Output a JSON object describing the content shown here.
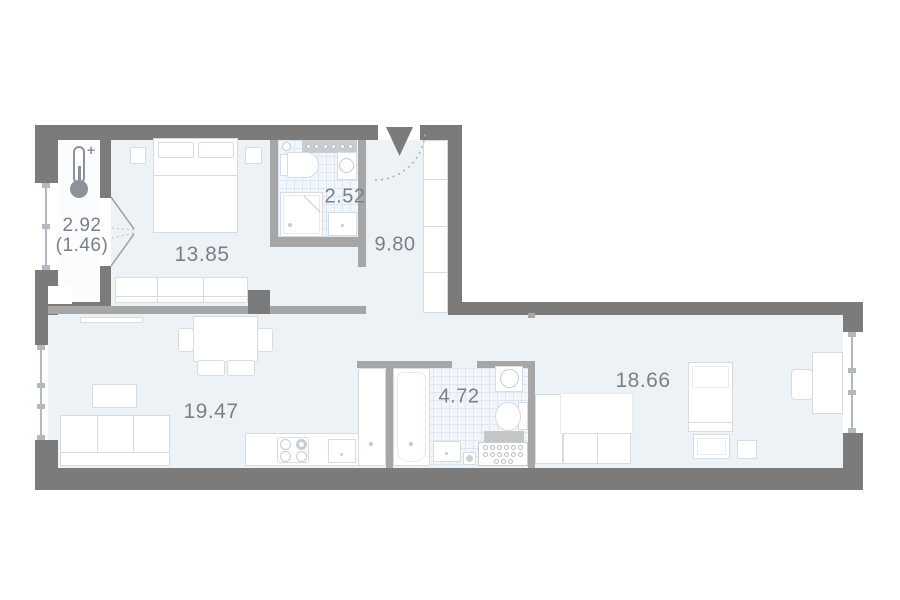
{
  "title": "Apartment floor plan",
  "rooms": {
    "balcony": {
      "name": "balcony",
      "area": "2.92",
      "area_reduced": "(1.46)"
    },
    "bedroom": {
      "name": "bedroom",
      "area": "13.85"
    },
    "bathroom_small": {
      "name": "bathroom",
      "area": "2.52"
    },
    "hallway": {
      "name": "hallway",
      "area": "9.80"
    },
    "living_kitchen": {
      "name": "living-kitchen",
      "area": "19.47"
    },
    "bathroom_large": {
      "name": "bathroom",
      "area": "4.72"
    },
    "bedroom_second": {
      "name": "bedroom",
      "area": "18.66"
    }
  },
  "icons": {
    "thermometer_plus": "+"
  },
  "colors": {
    "wall_dark": "#7b7b7b",
    "wall_partition": "#a6a6a6",
    "floor": "#edf2f7",
    "balcony_floor": "#fbfcfd",
    "tile": "#f2f6fa",
    "tile_grid": "#dce8f1",
    "furniture_border": "#d8dce0",
    "label_text": "#7b8087"
  }
}
